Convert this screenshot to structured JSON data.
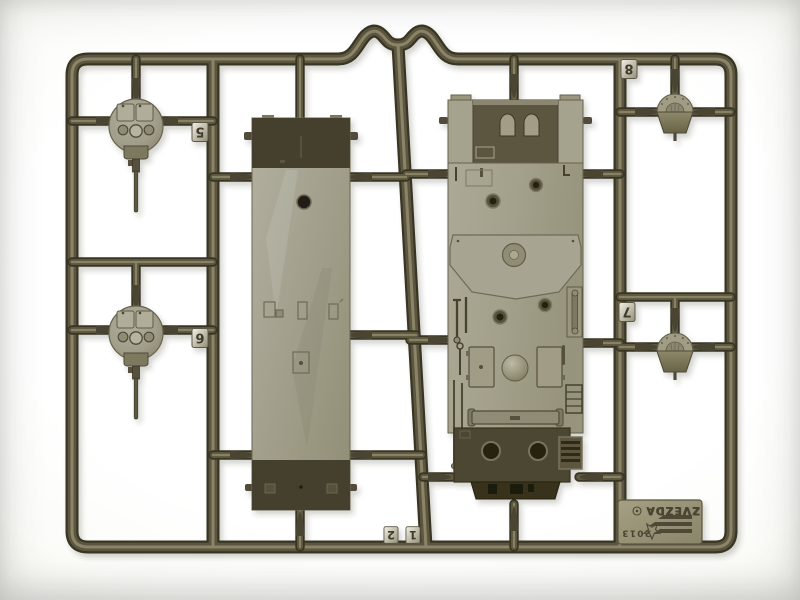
{
  "photo": {
    "subject": "olive-green injection-molded plastic model sprue with tank lower hull, flat hull plate, two round turrets with gun barrels and two domed cupolas",
    "background_color": "#f4f3ef",
    "plastic_colors": {
      "runner_dark": "#393424",
      "runner_mid": "#5c5741",
      "runner_highlight": "#8d8769",
      "part_light": "#a8a593",
      "part_dark": "#45412e"
    }
  },
  "sprue": {
    "brand": "ZVEZDA",
    "year": "2013",
    "registered_mark": "®",
    "tags": [
      {
        "label": "5"
      },
      {
        "label": "6"
      },
      {
        "label": "7"
      },
      {
        "label": "8"
      },
      {
        "label": "1"
      },
      {
        "label": "2"
      }
    ]
  }
}
